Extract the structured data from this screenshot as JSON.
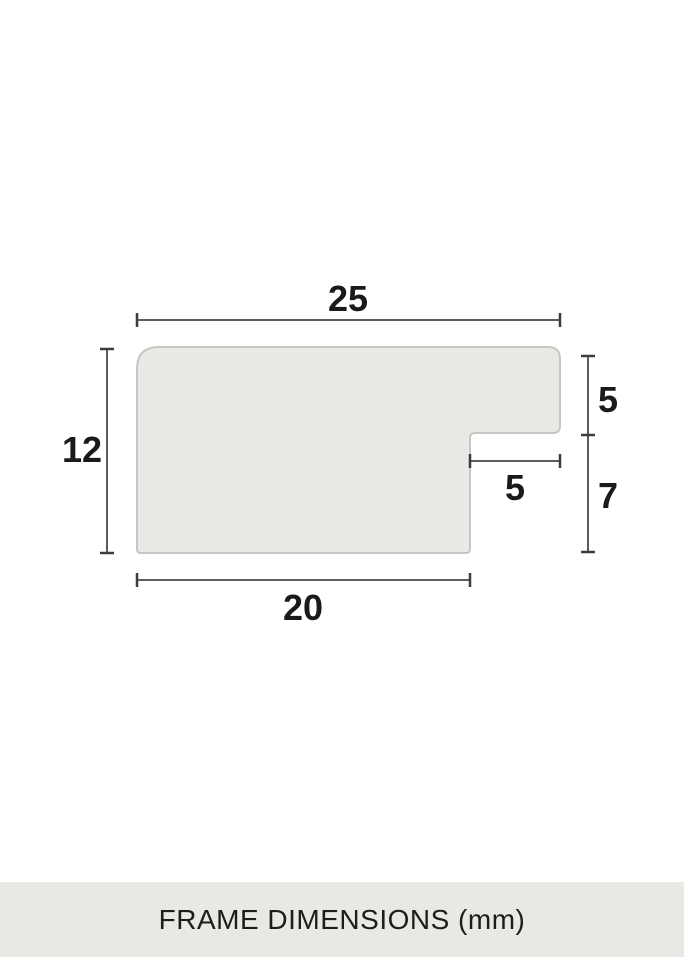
{
  "diagram": {
    "description": "frame-moulding-cross-section",
    "shape": {
      "fill": "#e9e9e5",
      "border": "#c6c6c2"
    },
    "line_color": "#5c5c5c",
    "label_color": "#1a1a1a",
    "dimensions": [
      {
        "id": "top-width",
        "value": "25"
      },
      {
        "id": "left-height",
        "value": "12"
      },
      {
        "id": "right-upper-height",
        "value": "5"
      },
      {
        "id": "notch-width",
        "value": "5"
      },
      {
        "id": "right-lower-height",
        "value": "7"
      },
      {
        "id": "bottom-width",
        "value": "20"
      }
    ]
  },
  "footer": {
    "caption": "FRAME DIMENSIONS (mm)",
    "background": "#e8e8e4",
    "text_color": "#1d1d1b"
  }
}
